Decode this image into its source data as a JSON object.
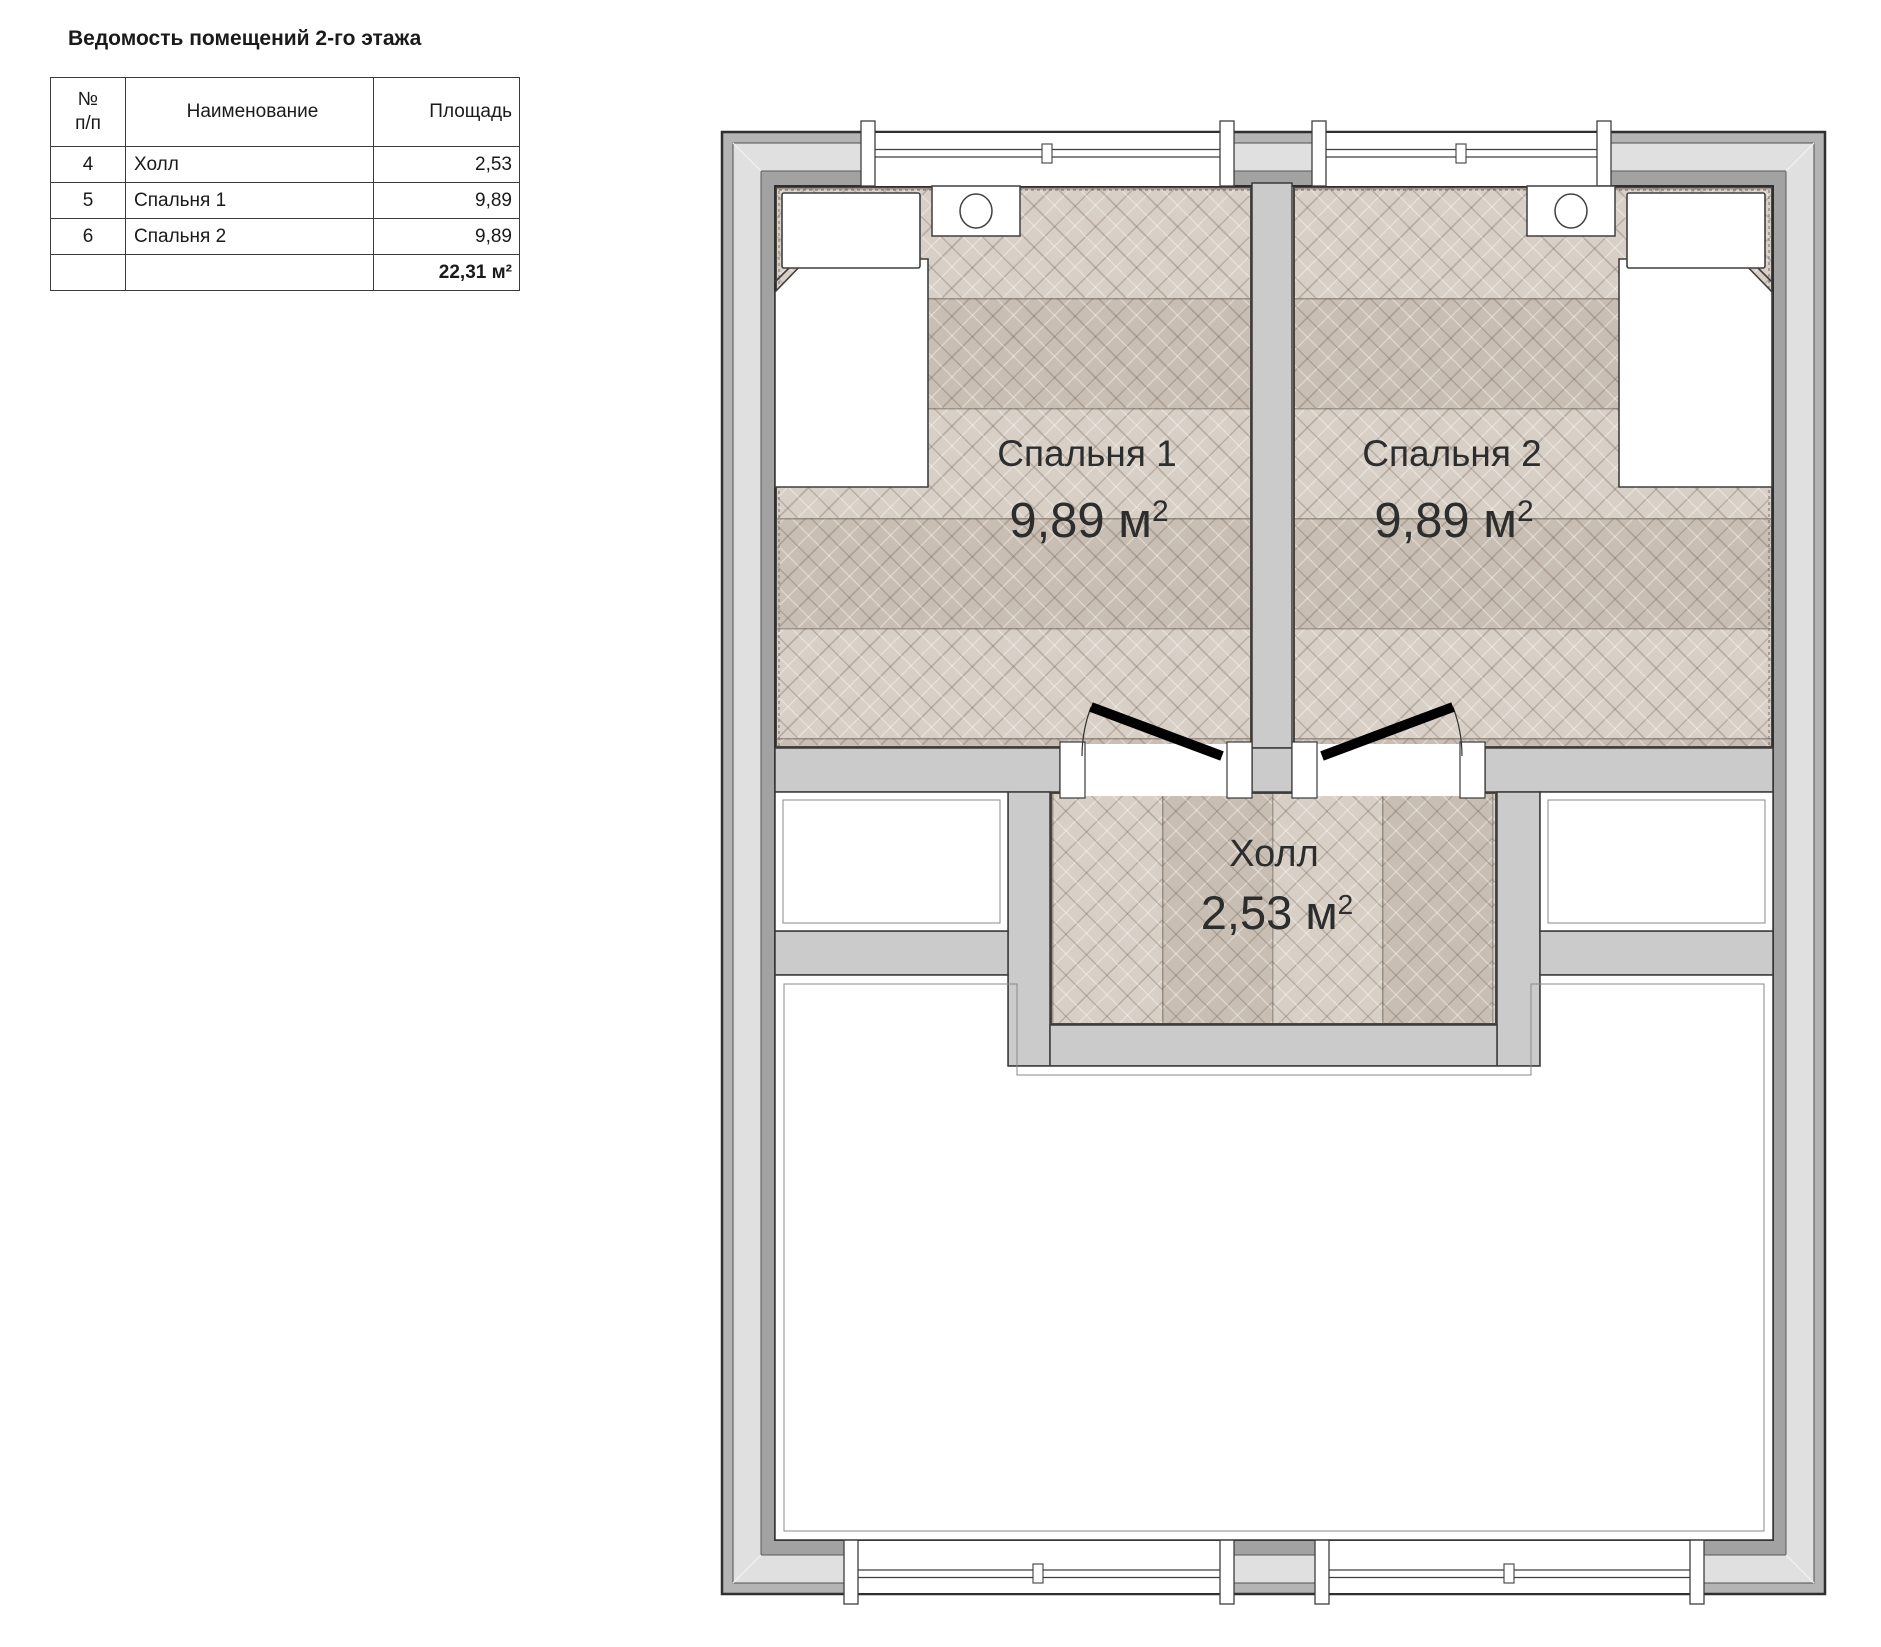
{
  "legend": {
    "title": "Ведомость помещений 2-го этажа",
    "columns": [
      "№\nп/п",
      "Наименование",
      "Площадь"
    ],
    "rows": [
      {
        "num": "4",
        "name": "Холл",
        "area": "2,53"
      },
      {
        "num": "5",
        "name": "Спальня 1",
        "area": "9,89"
      },
      {
        "num": "6",
        "name": "Спальня 2",
        "area": "9,89"
      }
    ],
    "total": "22,31 м²"
  },
  "plan": {
    "rooms": [
      {
        "name": "Спальня 1",
        "area": "9,89 м²"
      },
      {
        "name": "Спальня 2",
        "area": "9,89 м²"
      },
      {
        "name": "Холл",
        "area": "2,53 м²"
      }
    ],
    "colors": {
      "wall_outer_band": "#b4b4b4",
      "wall_light_band": "#e0e0e0",
      "wall_insulation_band": "#a2a2a2",
      "interior_wall": "#cbcbcb",
      "line": "#3a3a3a",
      "parquet_light": "#d8cfc6",
      "parquet_dark": "#c9beb4",
      "door_leaf": "#000000",
      "furniture_fill": "#ffffff"
    }
  }
}
